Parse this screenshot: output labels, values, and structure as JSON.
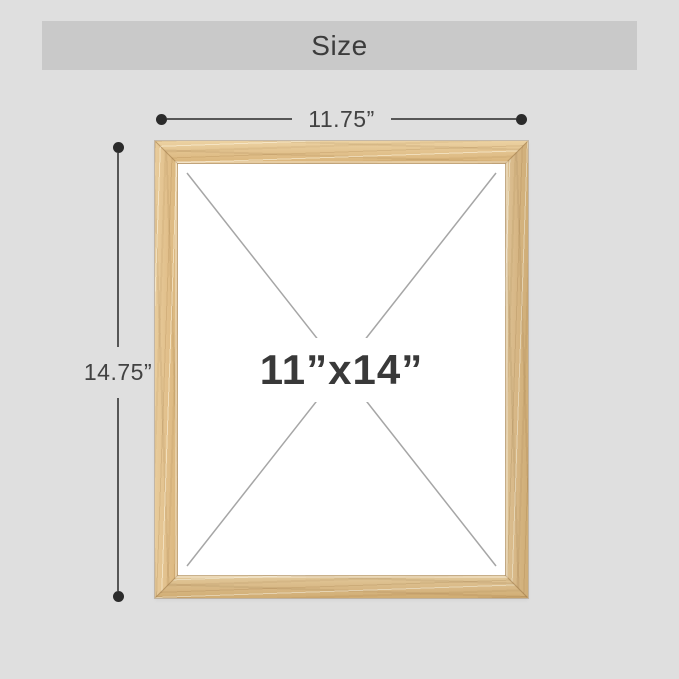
{
  "header": {
    "title": "Size"
  },
  "dimensions": {
    "width": {
      "label": "11.75”"
    },
    "height": {
      "label": "14.75”"
    }
  },
  "frame": {
    "size_label": "11”x14”"
  },
  "colors": {
    "page_background": "#dfdfdf",
    "header_bar": "#c9c9c9",
    "dimension_line": "#565656",
    "dimension_dot": "#2b2b2b",
    "label_text": "#424242",
    "wood": "#e0bf8c",
    "opening": "#ffffff",
    "diagonal_line": "#a6a6a6",
    "size_label_text": "#393939"
  }
}
